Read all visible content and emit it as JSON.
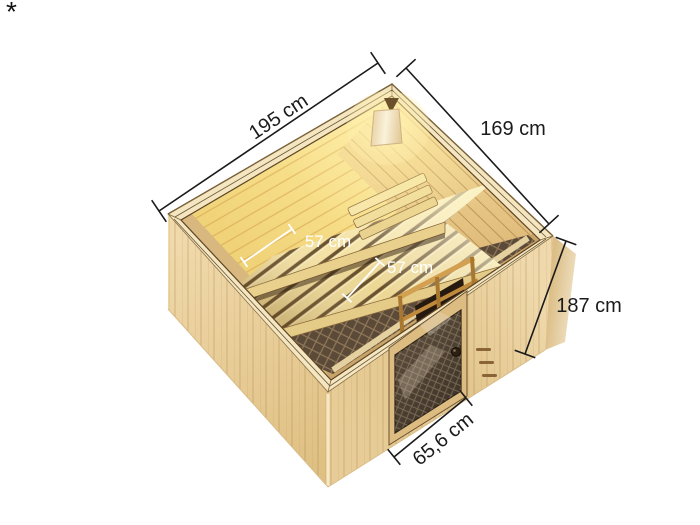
{
  "page": {
    "footnote_marker": "*",
    "background": "#ffffff"
  },
  "illustration": {
    "subject": "wooden sauna cabin seen from above with glass door, two slatted benches, corner lamp, heater guard and dark patterned floor mat",
    "colors": {
      "exterior_wood": "#ecd2a0",
      "interior_lit_wood": "#f7e18e",
      "bench_slats": "#f2df9f",
      "slat_gap": "#6b4e26",
      "floor_mat": "#5c4a38",
      "door_glass": "#4a3e31",
      "lamp_glow": "#ffe9a8",
      "dimension_line": "#1a1a1a",
      "interior_dimension_text": "#ffffff"
    }
  },
  "dimensions": {
    "back_left_edge": "195 cm",
    "back_right_edge": "169 cm",
    "height_right": "187 cm",
    "door_width": "65,6 cm",
    "upper_bench_depth": "57 cm",
    "lower_bench_depth": "57 cm"
  }
}
